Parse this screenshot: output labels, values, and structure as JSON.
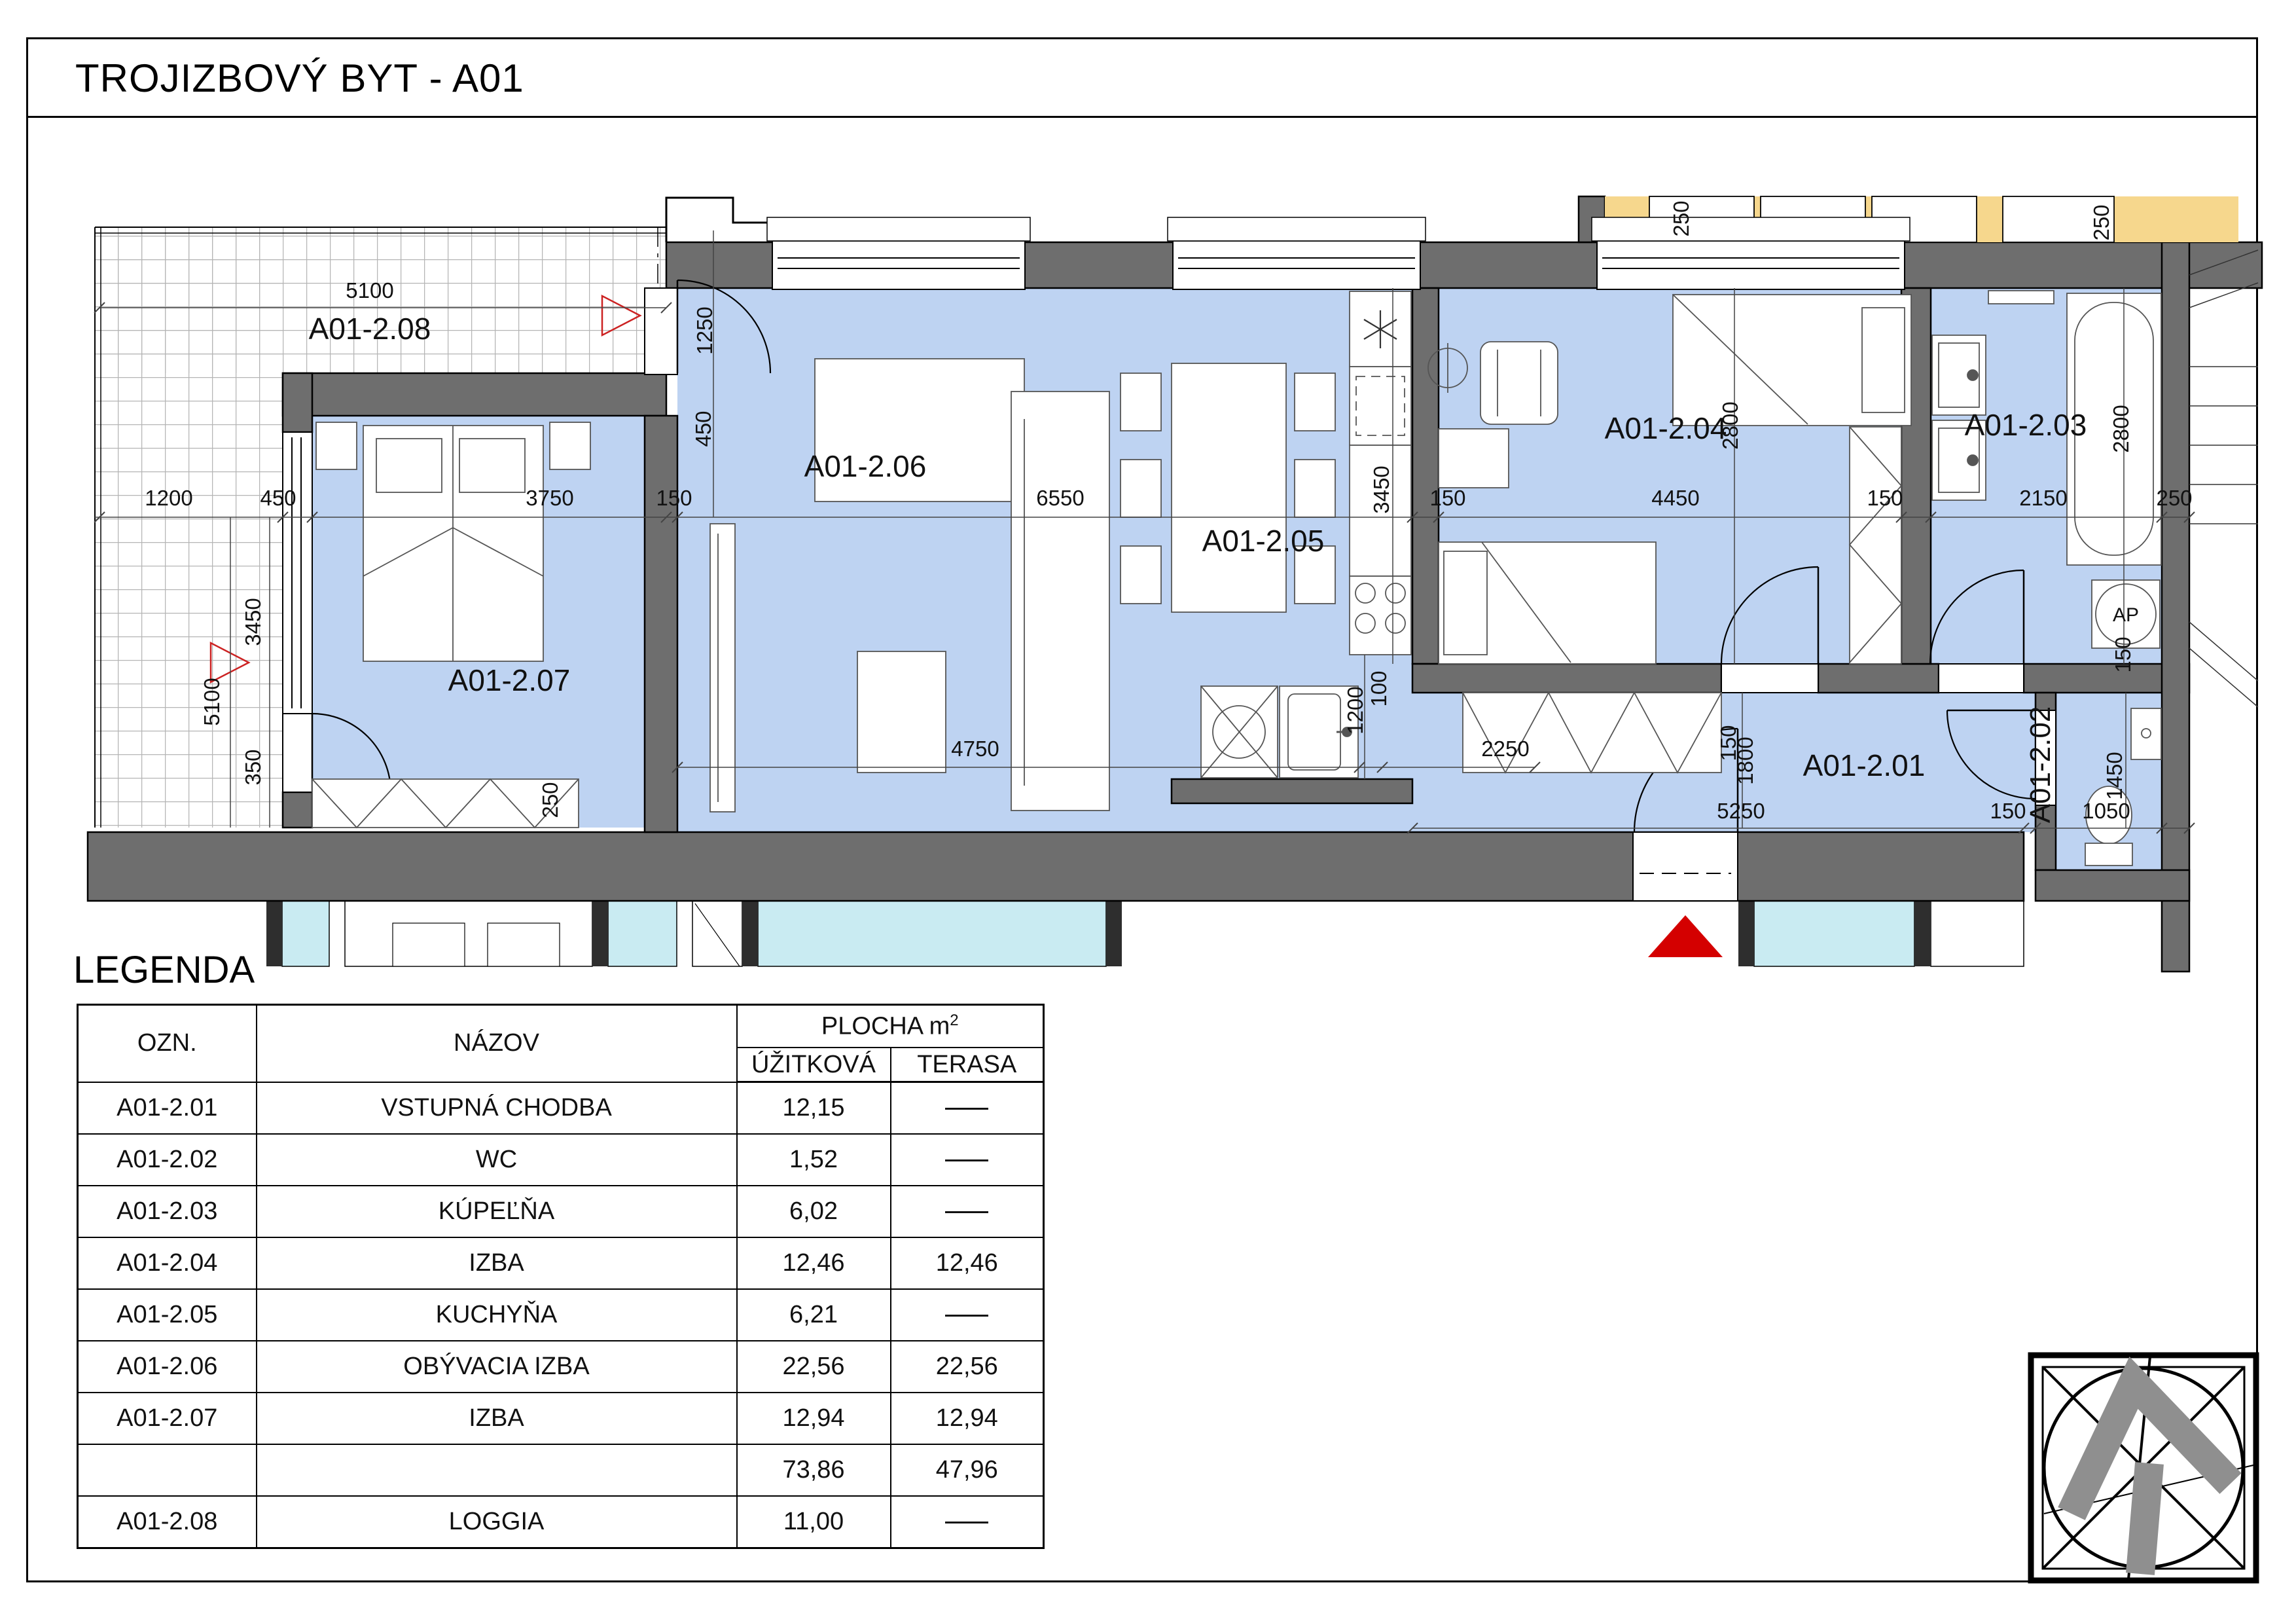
{
  "page": {
    "title": "TROJIZBOVÝ BYT - A01"
  },
  "plan": {
    "rooms": [
      "A01-2.08",
      "A01-2.07",
      "A01-2.06",
      "A01-2.05",
      "A01-2.04",
      "A01-2.03",
      "A01-2.02",
      "A01-2.01"
    ],
    "ap": "AP",
    "dims": [
      "5100",
      "1250",
      "450",
      "1200",
      "450",
      "3750",
      "150",
      "6550",
      "3450",
      "150",
      "4450",
      "150",
      "2150",
      "250",
      "2800",
      "2800",
      "5100",
      "3450",
      "350",
      "250",
      "4750",
      "1200",
      "100",
      "2250",
      "5250",
      "150",
      "1050",
      "1800",
      "1450",
      "150",
      "250",
      "250",
      "150"
    ]
  },
  "legend": {
    "heading": "LEGENDA",
    "header": {
      "ozn": "OZN.",
      "nazov": "NÁZOV",
      "plocha": "PLOCHA m",
      "plocha_sup": "2",
      "uzitkova": "ÚŽITKOVÁ",
      "terasa": "TERASA"
    },
    "rows": [
      {
        "ozn": "A01-2.01",
        "nazov": "VSTUPNÁ CHODBA",
        "uzitkova": "12,15",
        "terasa": ""
      },
      {
        "ozn": "A01-2.02",
        "nazov": "WC",
        "uzitkova": "1,52",
        "terasa": ""
      },
      {
        "ozn": "A01-2.03",
        "nazov": "KÚPEĽŇA",
        "uzitkova": "6,02",
        "terasa": ""
      },
      {
        "ozn": "A01-2.04",
        "nazov": "IZBA",
        "uzitkova": "12,46",
        "terasa": "12,46"
      },
      {
        "ozn": "A01-2.05",
        "nazov": "KUCHYŇA",
        "uzitkova": "6,21",
        "terasa": ""
      },
      {
        "ozn": "A01-2.06",
        "nazov": "OBÝVACIA IZBA",
        "uzitkova": "22,56",
        "terasa": "22,56"
      },
      {
        "ozn": "A01-2.07",
        "nazov": "IZBA",
        "uzitkova": "12,94",
        "terasa": "12,94"
      }
    ],
    "total": {
      "uzitkova": "73,86",
      "terasa": "47,96"
    },
    "loggia_row": {
      "ozn": "A01-2.08",
      "nazov": "LOGGIA",
      "uzitkova": "11,00",
      "terasa": ""
    }
  },
  "colors": {
    "room_fill": "#BED3F2",
    "wall": "#6E6E6E",
    "neighbor_fill": "#F6D78D",
    "lower_flat_window": "#C9EBF2",
    "accent_red": "#D40000"
  }
}
